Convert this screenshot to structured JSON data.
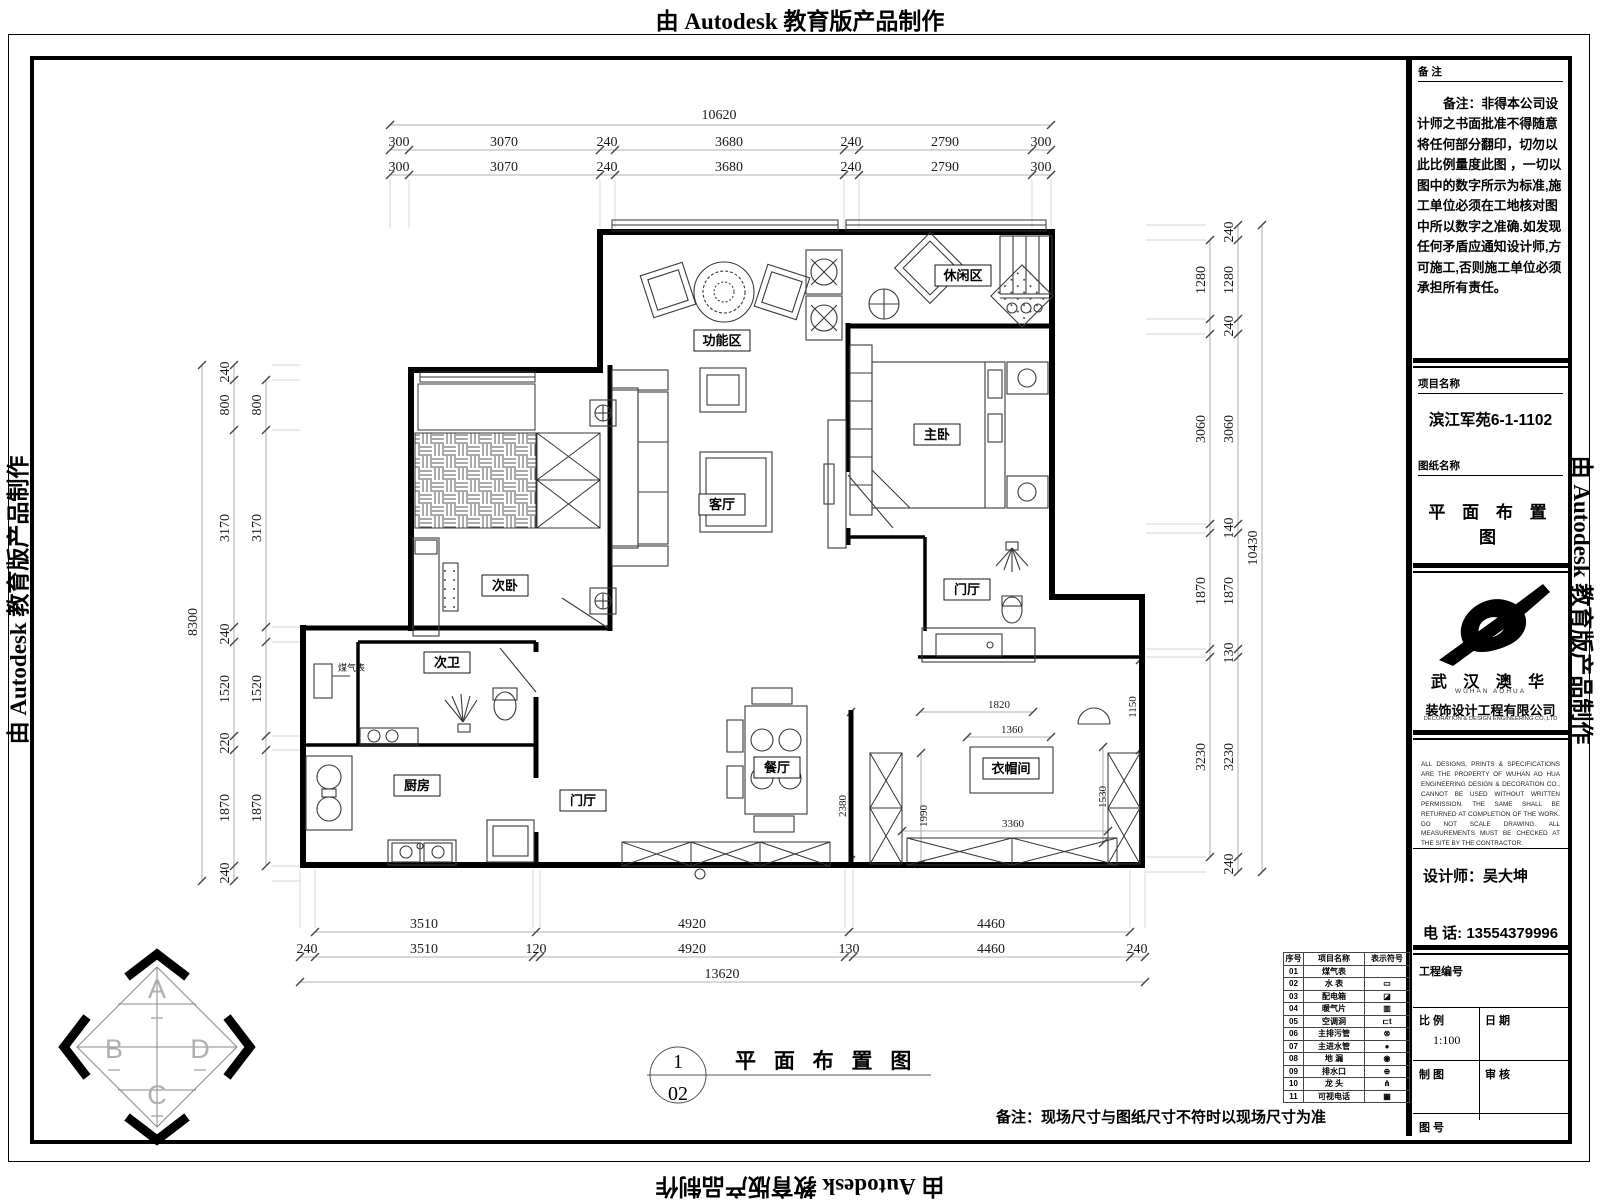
{
  "watermark": "由 Autodesk 教育版产品制作",
  "sidebar": {
    "notes_header": "备  注",
    "notes_body": "备注：非得本公司设计师之书面批准不得随意将任何部分翻印，切勿以此比例量度此图 ，一切以图中的数字所示为标准,施工单位必须在工地核对图中所以数字之准确.如发现任何矛盾应通知设计师,方可施工,否则施工单位必须承担所有责任。",
    "project_label": "项目名称",
    "project_name": "滨江军苑6-1-1102",
    "drawing_label": "图纸名称",
    "drawing_name": "平 面 布 置 图",
    "logo_cn": "武 汉 澳 华",
    "logo_en": "WUHAN   AOHUA",
    "company_cn": "装饰设计工程有限公司",
    "company_en": "DECORATION & DESIGN ENGINEERING CO.,LTD",
    "disclaimer": "ALL DESIGNS, PRINTS & SPECIFICATIONS ARE THE PROPERTY OF WUHAN AO HUA ENGINEERING DESIGN & DECORATION CO., CANNOT BE USED WITHOUT WRITTEN PERMISSION. THE SAME SHALL BE RETURNED AT COMPLETION OF THE WORK. DO NOT SCALE DRAWING. ALL MEASUREMENTS MUST BE CHECKED AT THE SITE BY THE CONTRACTOR.",
    "designer_label": "设计师：吴大坤",
    "phone_label": "电 话: 13554379996",
    "project_no_label": "工程编号",
    "scale_label": "比 例",
    "scale_value": "1:100",
    "date_label": "日 期",
    "draft_label": "制 图",
    "check_label": "审 核",
    "sheet_label": "图 号"
  },
  "legend": {
    "headers": [
      "序号",
      "项目名称",
      "表示符号"
    ],
    "rows": [
      {
        "no": "01",
        "name": "煤气表",
        "sym": ""
      },
      {
        "no": "02",
        "name": "水 表",
        "sym": "▭"
      },
      {
        "no": "03",
        "name": "配电箱",
        "sym": "◪"
      },
      {
        "no": "04",
        "name": "暖气片",
        "sym": "▥"
      },
      {
        "no": "05",
        "name": "空调洞",
        "sym": "⊏t"
      },
      {
        "no": "06",
        "name": "主排污管",
        "sym": "⊗"
      },
      {
        "no": "07",
        "name": "主进水管",
        "sym": "●"
      },
      {
        "no": "08",
        "name": "地 漏",
        "sym": "◉"
      },
      {
        "no": "09",
        "name": "排水口",
        "sym": "⊕"
      },
      {
        "no": "10",
        "name": "龙 头",
        "sym": "⋔"
      },
      {
        "no": "11",
        "name": "可视电话",
        "sym": "▦"
      }
    ]
  },
  "footer": {
    "fig_top": "1",
    "fig_bottom": "02",
    "title": "平 面 布 置 图",
    "note": "备注：现场尺寸与图纸尺寸不符时以现场尺寸为准"
  },
  "compass": {
    "a": "A",
    "b": "B",
    "c": "C",
    "d": "D"
  },
  "plan": {
    "rooms": {
      "gongnengqu": "功能区",
      "xiuxianqu": "休闲区",
      "zhuwo": "主卧",
      "keting": "客厅",
      "ciwo": "次卧",
      "mentingshang": "门厅",
      "ciwei": "次卫",
      "chufang": "厨房",
      "mentingxia": "门厅",
      "canting": "餐厅",
      "yimaojian": "衣帽间"
    },
    "gas_meter": "煤气表",
    "dims": {
      "top_overall": "10620",
      "top": [
        "300",
        "3070",
        "240",
        "3680",
        "240",
        "2790",
        "300"
      ],
      "bottom_overall": "13620",
      "bottom_mid": [
        "3510",
        "4920",
        "4460"
      ],
      "bottom": [
        "240",
        "3510",
        "120",
        "4920",
        "130",
        "4460",
        "240"
      ],
      "left_overall": "8300",
      "left": [
        "240",
        "800",
        "3170",
        "240",
        "1520",
        "220",
        "1870",
        "240"
      ],
      "left_inner": [
        "800",
        "3170",
        "1520",
        "1870"
      ],
      "right_overall": "10430",
      "right": [
        "240",
        "1280",
        "240",
        "3060",
        "140",
        "1870",
        "130",
        "3230",
        "240"
      ],
      "right_inner": [
        "1280",
        "3060",
        "1870",
        "3230"
      ],
      "interior": {
        "a": "1820",
        "b": "1360",
        "c": "1150",
        "d": "1990",
        "e": "1530",
        "f": "3360",
        "g": "2380"
      }
    }
  }
}
